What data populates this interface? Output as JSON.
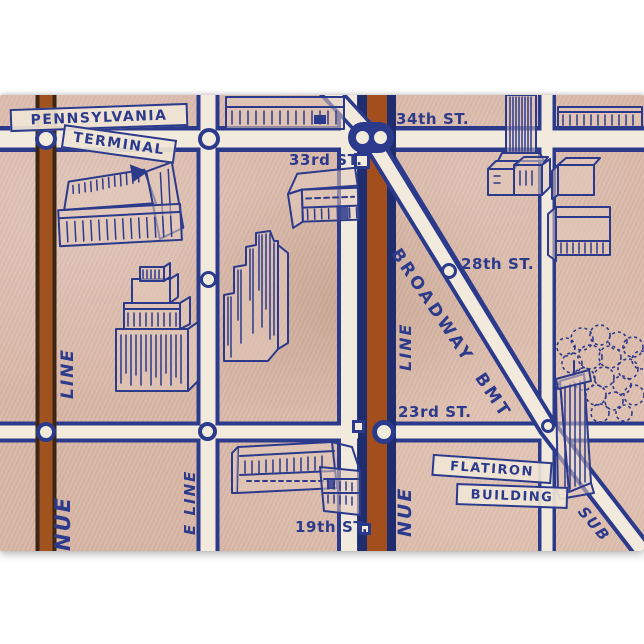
{
  "map": {
    "description": "vintage-new-york-subway-map-print",
    "palette": {
      "paper": "#d8b6a6",
      "ink_blue": "#2c3a8c",
      "street_cream": "#f2ebdd",
      "avenue_brown": "#a0521f",
      "avenue_brown_dark": "#3c2514",
      "margin_white": "#ffffff"
    },
    "banners": {
      "pennsylvania": "PENNSYLVANIA",
      "terminal": "TERMINAL",
      "flatiron_line1": "FLATIRON",
      "flatiron_line2": "BUILDING"
    },
    "street_labels": {
      "st34": "34th ST.",
      "st33": "33rd ST.",
      "st28": "28th ST.",
      "st23": "23rd ST.",
      "st19": "19th ST."
    },
    "line_labels": {
      "broadway_bmt": "BROADWAY BMT",
      "left_line": "LINE",
      "left_avenue": "NUE",
      "seventh_line": "E LINE",
      "trunk_line": "LINE",
      "trunk_avenue": "NUE",
      "subway": "SUB"
    },
    "features": [
      "pennsylvania-terminal-building",
      "stepped-skyscraper",
      "department-store-ziggurat",
      "flatiron-building",
      "madison-square-park-trees",
      "station-markers"
    ]
  }
}
